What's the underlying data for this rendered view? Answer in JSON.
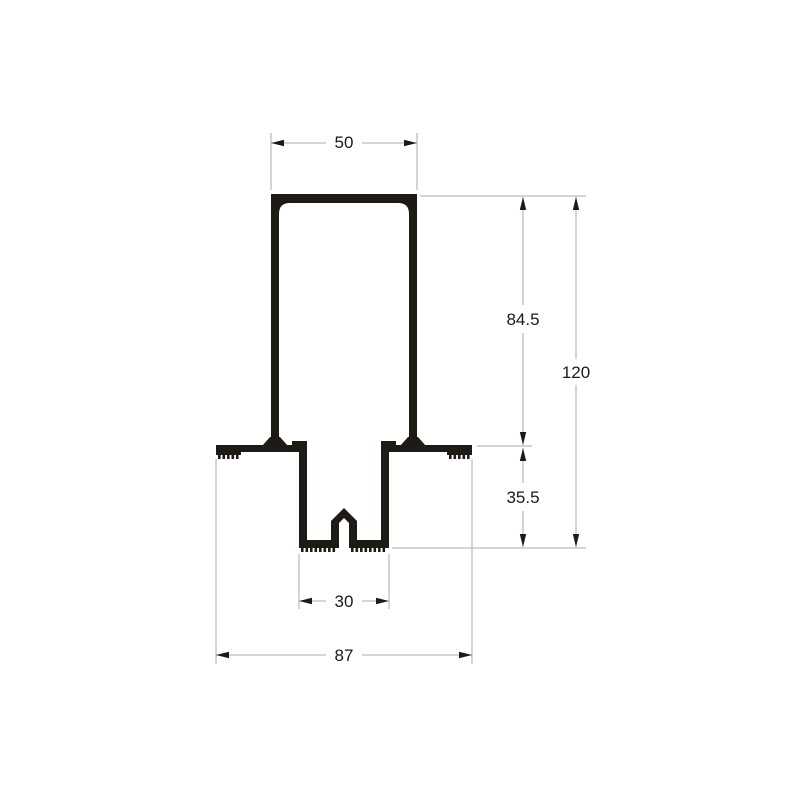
{
  "drawing": {
    "title": "Aluminium profile cross-section",
    "dimensions": {
      "top_width": "50",
      "upper_height": "84.5",
      "total_height": "120",
      "lower_depth": "35.5",
      "channel_width": "30",
      "base_width": "87"
    },
    "colors": {
      "profile_ink": "#1e1b17",
      "dimension_lines": "#ababab",
      "dimension_text": "#1a1a1a",
      "background": "#ffffff"
    }
  }
}
